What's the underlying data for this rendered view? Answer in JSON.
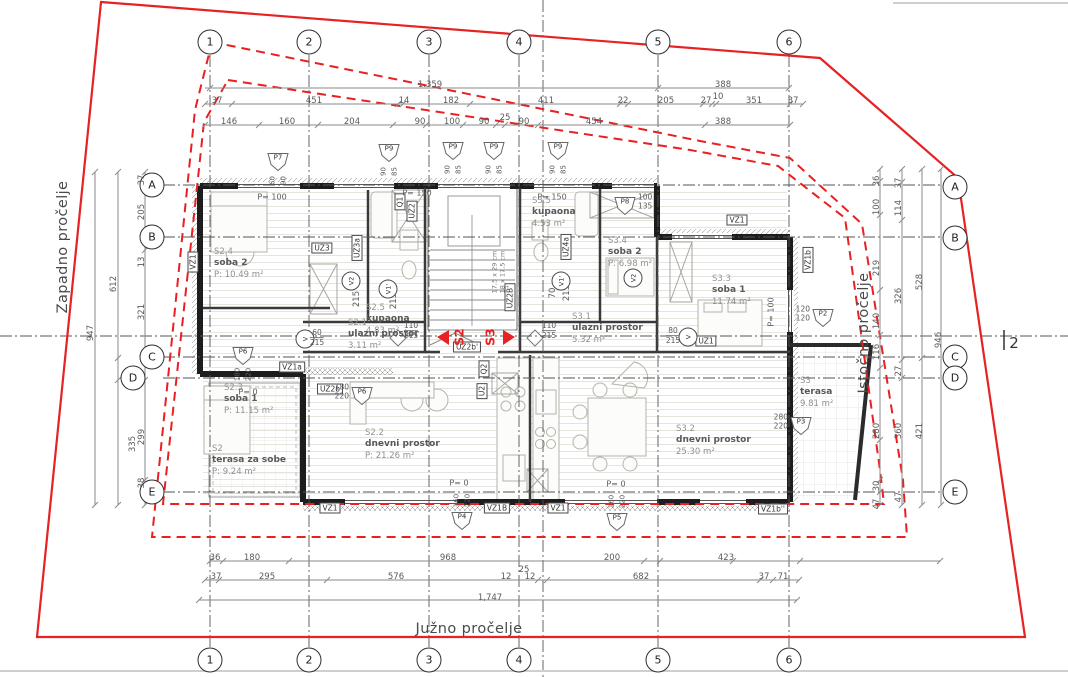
{
  "drawing": "floor-plan",
  "colors": {
    "boundary_red": "#e62222",
    "wall_dark": "#1d1d1d",
    "dim_gray": "#5a5a5a",
    "grid_gray": "#555555"
  },
  "facades": {
    "west": "Zapadno pročelje",
    "east": "Istočno pročelje",
    "south": "Južno pročelje"
  },
  "section_right_label": "2",
  "section_markers": {
    "left_label": "S2",
    "right_label": "S3",
    "lx": 459,
    "rx": 490,
    "y": 337
  },
  "grid_bubbles": [
    {
      "t": "1",
      "x": 210,
      "y": 42
    },
    {
      "t": "2",
      "x": 309,
      "y": 42
    },
    {
      "t": "3",
      "x": 429,
      "y": 42
    },
    {
      "t": "4",
      "x": 519,
      "y": 42
    },
    {
      "t": "5",
      "x": 658,
      "y": 42
    },
    {
      "t": "6",
      "x": 789,
      "y": 42
    },
    {
      "t": "1",
      "x": 210,
      "y": 660
    },
    {
      "t": "2",
      "x": 309,
      "y": 660
    },
    {
      "t": "3",
      "x": 429,
      "y": 660
    },
    {
      "t": "4",
      "x": 519,
      "y": 660
    },
    {
      "t": "5",
      "x": 658,
      "y": 660
    },
    {
      "t": "6",
      "x": 789,
      "y": 660
    },
    {
      "t": "A",
      "x": 152,
      "y": 185
    },
    {
      "t": "B",
      "x": 152,
      "y": 237
    },
    {
      "t": "C",
      "x": 152,
      "y": 357
    },
    {
      "t": "D",
      "x": 133,
      "y": 378
    },
    {
      "t": "E",
      "x": 152,
      "y": 492
    },
    {
      "t": "A",
      "x": 955,
      "y": 187
    },
    {
      "t": "B",
      "x": 955,
      "y": 238
    },
    {
      "t": "C",
      "x": 955,
      "y": 357
    },
    {
      "t": "D",
      "x": 955,
      "y": 378
    },
    {
      "t": "E",
      "x": 955,
      "y": 492
    }
  ],
  "dims": [
    {
      "t": "1.359",
      "x": 430,
      "y": 85
    },
    {
      "t": "388",
      "x": 723,
      "y": 85
    },
    {
      "t": "37",
      "x": 217,
      "y": 101
    },
    {
      "t": "451",
      "x": 314,
      "y": 101
    },
    {
      "t": "14",
      "x": 404,
      "y": 101
    },
    {
      "t": "182",
      "x": 451,
      "y": 101
    },
    {
      "t": "411",
      "x": 546,
      "y": 101
    },
    {
      "t": "22",
      "x": 623,
      "y": 101
    },
    {
      "t": "205",
      "x": 666,
      "y": 101
    },
    {
      "t": "27",
      "x": 706,
      "y": 101
    },
    {
      "t": "10",
      "x": 718,
      "y": 97
    },
    {
      "t": "351",
      "x": 754,
      "y": 101
    },
    {
      "t": "37",
      "x": 793,
      "y": 101
    },
    {
      "t": "146",
      "x": 229,
      "y": 122
    },
    {
      "t": "160",
      "x": 287,
      "y": 122
    },
    {
      "t": "204",
      "x": 352,
      "y": 122
    },
    {
      "t": "90",
      "x": 420,
      "y": 122
    },
    {
      "t": "100",
      "x": 452,
      "y": 122
    },
    {
      "t": "90",
      "x": 484,
      "y": 122
    },
    {
      "t": "25",
      "x": 505,
      "y": 118
    },
    {
      "t": "90",
      "x": 524,
      "y": 122
    },
    {
      "t": "454",
      "x": 594,
      "y": 122
    },
    {
      "t": "388",
      "x": 723,
      "y": 122
    },
    {
      "t": "36",
      "x": 215,
      "y": 558
    },
    {
      "t": "180",
      "x": 252,
      "y": 558
    },
    {
      "t": "968",
      "x": 448,
      "y": 558
    },
    {
      "t": "200",
      "x": 612,
      "y": 558
    },
    {
      "t": "423",
      "x": 726,
      "y": 558
    },
    {
      "t": "25",
      "x": 524,
      "y": 570
    },
    {
      "t": "37",
      "x": 216,
      "y": 577
    },
    {
      "t": "295",
      "x": 267,
      "y": 577
    },
    {
      "t": "576",
      "x": 396,
      "y": 577
    },
    {
      "t": "12",
      "x": 506,
      "y": 577
    },
    {
      "t": "12",
      "x": 530,
      "y": 577
    },
    {
      "t": "682",
      "x": 641,
      "y": 577
    },
    {
      "t": "37",
      "x": 764,
      "y": 577
    },
    {
      "t": "71",
      "x": 783,
      "y": 577
    },
    {
      "t": "1,747",
      "x": 490,
      "y": 598
    },
    {
      "t": "947",
      "x": 91,
      "y": 333,
      "r": 1
    },
    {
      "t": "612",
      "x": 114,
      "y": 284,
      "r": 1
    },
    {
      "t": "335",
      "x": 133,
      "y": 444,
      "r": 1
    },
    {
      "t": "37",
      "x": 142,
      "y": 180,
      "r": 1
    },
    {
      "t": "205",
      "x": 142,
      "y": 212,
      "r": 1
    },
    {
      "t": "13",
      "x": 142,
      "y": 262,
      "r": 1
    },
    {
      "t": "321",
      "x": 142,
      "y": 312,
      "r": 1
    },
    {
      "t": "299",
      "x": 142,
      "y": 437,
      "r": 1
    },
    {
      "t": "38",
      "x": 142,
      "y": 483,
      "r": 1
    },
    {
      "t": "36",
      "x": 877,
      "y": 181,
      "r": 1
    },
    {
      "t": "100",
      "x": 877,
      "y": 207,
      "r": 1
    },
    {
      "t": "219",
      "x": 877,
      "y": 268,
      "r": 1
    },
    {
      "t": "140",
      "x": 877,
      "y": 321,
      "r": 1
    },
    {
      "t": "116",
      "x": 877,
      "y": 352,
      "r": 1
    },
    {
      "t": "280",
      "x": 877,
      "y": 431,
      "r": 1
    },
    {
      "t": "30",
      "x": 877,
      "y": 486,
      "r": 1
    },
    {
      "t": "47",
      "x": 877,
      "y": 504,
      "r": 1
    },
    {
      "t": "37",
      "x": 899,
      "y": 183,
      "r": 1
    },
    {
      "t": "114",
      "x": 899,
      "y": 208,
      "r": 1
    },
    {
      "t": "326",
      "x": 899,
      "y": 296,
      "r": 1
    },
    {
      "t": "27",
      "x": 899,
      "y": 371,
      "r": 1
    },
    {
      "t": "360",
      "x": 899,
      "y": 431,
      "r": 1
    },
    {
      "t": "47",
      "x": 899,
      "y": 497,
      "r": 1
    },
    {
      "t": "528",
      "x": 920,
      "y": 282,
      "r": 1
    },
    {
      "t": "421",
      "x": 920,
      "y": 431,
      "r": 1
    },
    {
      "t": "946",
      "x": 939,
      "y": 340,
      "r": 1
    },
    {
      "t": "215",
      "x": 357,
      "y": 299,
      "r": 1
    },
    {
      "t": "215",
      "x": 394,
      "y": 301,
      "r": 1
    },
    {
      "t": "70",
      "x": 553,
      "y": 293,
      "r": 1
    },
    {
      "t": "215",
      "x": 567,
      "y": 293,
      "r": 1
    }
  ],
  "rooms": [
    {
      "id": "S2.4",
      "name": "soba 2",
      "area": "P: 10.49 m²",
      "x": 214,
      "y": 247
    },
    {
      "id": "S2.3",
      "name": "soba 1",
      "area": "P: 11.15 m²",
      "x": 224,
      "y": 383
    },
    {
      "id": "S2.5",
      "name": "kupaona",
      "area": "4.83 m²",
      "x": 366,
      "y": 303
    },
    {
      "id": "S2.1",
      "name": "ulazni prostor",
      "area": "3.11 m²",
      "x": 348,
      "y": 318
    },
    {
      "id": "S3.5",
      "name": "kupaona",
      "area": "4.53 m²",
      "x": 532,
      "y": 196
    },
    {
      "id": "S3.4",
      "name": "soba 2",
      "area": "P: 6.98 m²",
      "x": 608,
      "y": 236
    },
    {
      "id": "S3.3",
      "name": "soba 1",
      "area": "11.74 m²",
      "x": 712,
      "y": 274
    },
    {
      "id": "S3.1",
      "name": "ulazni prostor",
      "area": "5.32 m²",
      "x": 572,
      "y": 312
    },
    {
      "id": "S2.2",
      "name": "dnevni prostor",
      "area": "P: 21.26 m²",
      "x": 365,
      "y": 428
    },
    {
      "id": "S3.2",
      "name": "dnevni prostor",
      "area": "25.30 m²",
      "x": 676,
      "y": 424
    },
    {
      "id": "S2",
      "name": "terasa za sobe",
      "area": "P: 9.24 m²",
      "x": 212,
      "y": 444
    },
    {
      "id": "S3",
      "name": "terasa",
      "area": "9.81 m²",
      "x": 800,
      "y": 376
    }
  ],
  "wall_tags": [
    {
      "t": "VZ1",
      "x": 193,
      "y": 262,
      "r": 1
    },
    {
      "t": "UZ3",
      "x": 322,
      "y": 248
    },
    {
      "t": "UZ3a",
      "x": 357,
      "y": 248,
      "r": 1
    },
    {
      "t": "Q1",
      "x": 400,
      "y": 202,
      "r": 1
    },
    {
      "t": "UZ2",
      "x": 412,
      "y": 211,
      "r": 1
    },
    {
      "t": "UZ4a",
      "x": 566,
      "y": 247,
      "r": 1
    },
    {
      "t": "UZ2B'",
      "x": 510,
      "y": 297,
      "r": 1
    },
    {
      "t": "UZ2b'",
      "x": 467,
      "y": 347
    },
    {
      "t": "UZ2b",
      "x": 330,
      "y": 389
    },
    {
      "t": "VZ1a",
      "x": 292,
      "y": 367
    },
    {
      "t": "VZ1",
      "x": 737,
      "y": 220
    },
    {
      "t": "VZ1b",
      "x": 808,
      "y": 260,
      "r": 1
    },
    {
      "t": "UZ1",
      "x": 706,
      "y": 341
    },
    {
      "t": "VZ1",
      "x": 330,
      "y": 508
    },
    {
      "t": "VZ1B",
      "x": 497,
      "y": 508
    },
    {
      "t": "VZ1",
      "x": 558,
      "y": 508
    },
    {
      "t": "VZ1b''",
      "x": 773,
      "y": 509
    },
    {
      "t": "Q2",
      "x": 484,
      "y": 369,
      "r": 1
    },
    {
      "t": "U2",
      "x": 482,
      "y": 391,
      "r": 1
    }
  ],
  "window_tags": [
    {
      "t": "P7",
      "x": 278,
      "y": 162,
      "d1": "60",
      "d2": "90",
      "pos": "below"
    },
    {
      "t": "P9",
      "x": 389,
      "y": 153,
      "d1": "90",
      "d2": "85",
      "pos": "below"
    },
    {
      "t": "P9",
      "x": 453,
      "y": 151,
      "d1": "90",
      "d2": "85",
      "pos": "below"
    },
    {
      "t": "P9",
      "x": 494,
      "y": 151,
      "d1": "90",
      "d2": "85",
      "pos": "below"
    },
    {
      "t": "P9",
      "x": 558,
      "y": 151,
      "d1": "90",
      "d2": "85",
      "pos": "below"
    },
    {
      "t": "P8",
      "x": 625,
      "y": 206,
      "d1": "100",
      "d2": "135",
      "pos": "right"
    },
    {
      "t": "P2",
      "x": 823,
      "y": 318,
      "d1": "120",
      "d2": "120",
      "pos": "left"
    },
    {
      "t": "P6",
      "x": 243,
      "y": 356,
      "d1": "180",
      "d2": "220",
      "pos": "below"
    },
    {
      "t": "P6",
      "x": 362,
      "y": 396,
      "d1": "180",
      "d2": "220",
      "pos": "left"
    },
    {
      "t": "P4",
      "x": 462,
      "y": 521,
      "d1": "160",
      "d2": "220",
      "pos": "above"
    },
    {
      "t": "P5",
      "x": 617,
      "y": 522,
      "d1": "160",
      "d2": "220",
      "pos": "above"
    },
    {
      "t": "P3",
      "x": 801,
      "y": 426,
      "d1": "280",
      "d2": "220",
      "pos": "left"
    }
  ],
  "vent_tags": [
    {
      "t": "V2",
      "x": 351,
      "y": 281
    },
    {
      "t": "V1'",
      "x": 388,
      "y": 289
    },
    {
      "t": "V1'",
      "x": 561,
      "y": 281
    },
    {
      "t": "V2",
      "x": 633,
      "y": 278
    },
    {
      "t": "V",
      "x": 305,
      "y": 339
    },
    {
      "t": "V",
      "x": 688,
      "y": 337
    }
  ],
  "door_dims": [
    {
      "a": "110",
      "b": "215",
      "x": 411,
      "y": 331
    },
    {
      "a": "110",
      "b": "215",
      "x": 549,
      "y": 331
    },
    {
      "a": "60",
      "b": "215",
      "x": 317,
      "y": 338
    },
    {
      "a": "80",
      "b": "215",
      "x": 673,
      "y": 336
    }
  ],
  "p_values": [
    {
      "t": "P= 100",
      "x": 272,
      "y": 197
    },
    {
      "t": "P= 150",
      "x": 417,
      "y": 193
    },
    {
      "t": "P= 150",
      "x": 552,
      "y": 197
    },
    {
      "t": "P= 0",
      "x": 248,
      "y": 392
    },
    {
      "t": "P= 0",
      "x": 459,
      "y": 483
    },
    {
      "t": "P= 0",
      "x": 616,
      "y": 484
    },
    {
      "t": "P= 100",
      "x": 771,
      "y": 312,
      "r": 1
    }
  ],
  "stair_note": {
    "line1": "17,5 x 29 cm",
    "line2": "18 x 17,5 cm",
    "x": 499,
    "y": 272
  }
}
